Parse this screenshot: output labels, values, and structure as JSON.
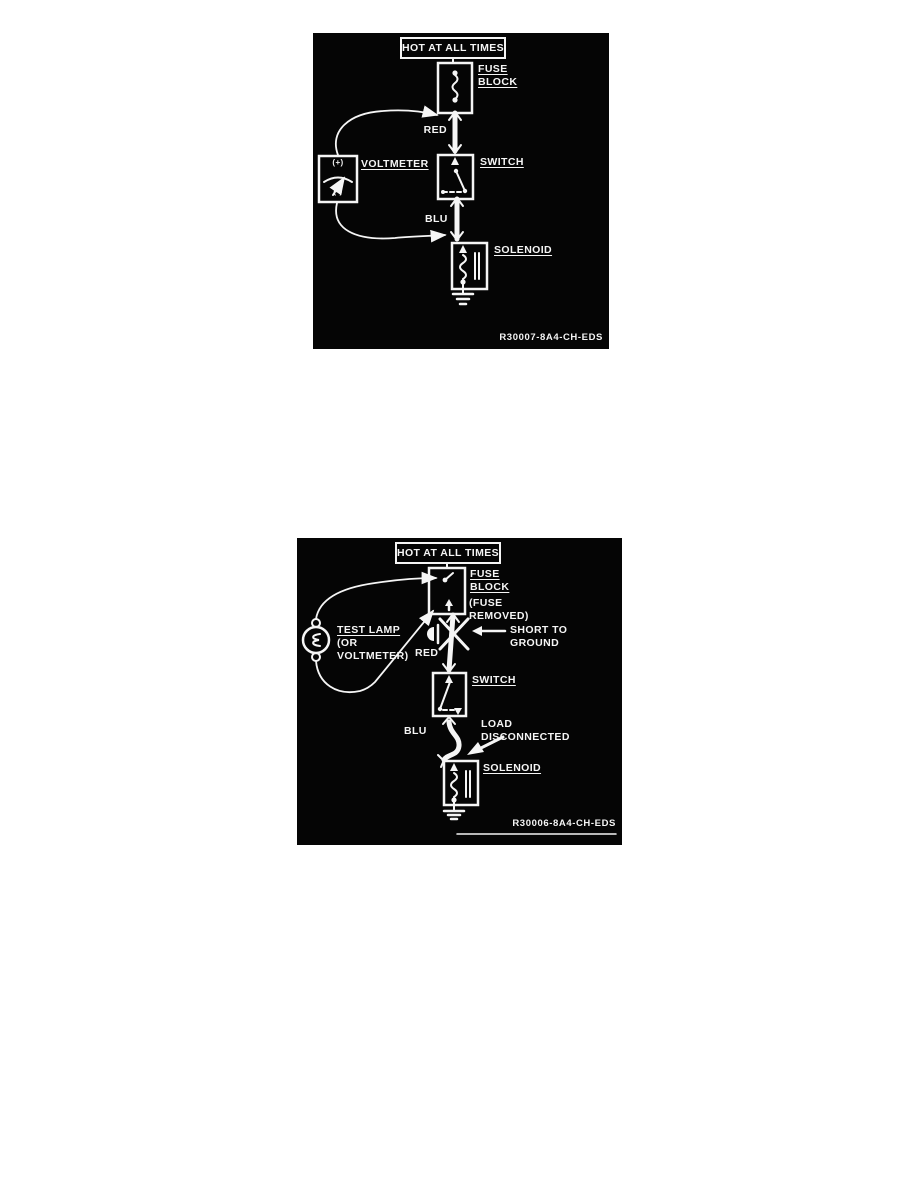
{
  "colors": {
    "page_bg": "#ffffff",
    "panel_bg": "#050505",
    "ink": "#f5f5f5"
  },
  "diagram_top": {
    "banner": "HOT AT ALL TIMES",
    "labels": {
      "fuse_line1": "FUSE",
      "fuse_line2": "BLOCK",
      "wire_red": "RED",
      "voltmeter": "VOLTMETER",
      "meter_plus": "(+)",
      "meter_minus": "(-)",
      "switch": "SWITCH",
      "wire_blu": "BLU",
      "solenoid": "SOLENOID",
      "ref": "R30007-8A4-CH-EDS"
    }
  },
  "diagram_bottom": {
    "banner": "HOT AT ALL TIMES",
    "labels": {
      "fuse_line1": "FUSE",
      "fuse_line2": "BLOCK",
      "fuse_note_line1": "(FUSE",
      "fuse_note_line2": "REMOVED)",
      "test_lamp_line1": "TEST LAMP",
      "test_lamp_line2": "(OR",
      "test_lamp_line3": "VOLTMETER)",
      "short_line1": "SHORT TO",
      "short_line2": "GROUND",
      "wire_red": "RED",
      "switch": "SWITCH",
      "wire_blu": "BLU",
      "load_line1": "LOAD",
      "load_line2": "DISCONNECTED",
      "solenoid": "SOLENOID",
      "ref": "R30006-8A4-CH-EDS"
    }
  }
}
